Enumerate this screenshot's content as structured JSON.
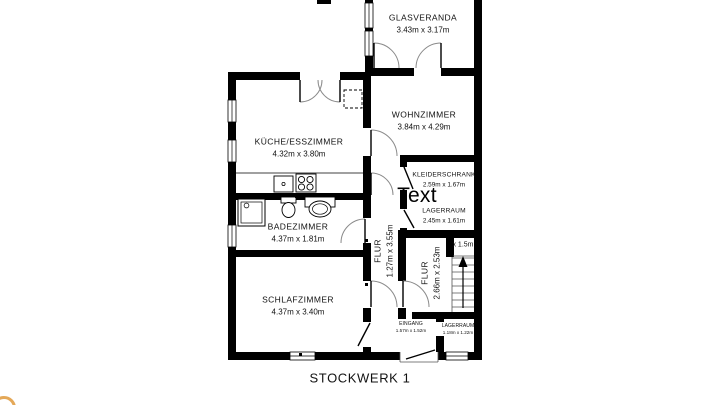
{
  "title": "STOCKWERK 1",
  "annotation": {
    "label": "Text"
  },
  "stairs": {
    "note": "x 1.5m",
    "icon": "up-arrow"
  },
  "rooms": {
    "glasveranda": {
      "name": "GLASVERANDA",
      "dims": "3.43m x 3.17m"
    },
    "wohnzimmer": {
      "name": "WOHNZIMMER",
      "dims": "3.84m x 4.29m"
    },
    "kueche": {
      "name": "KÜCHE/ESSZIMMER",
      "dims": "4.32m x 3.80m"
    },
    "kleiderschrank": {
      "name": "KLEIDERSCHRANK",
      "dims": "2.59m x 1.67m"
    },
    "lagerraum": {
      "name": "LAGERRAUM",
      "dims": "2.45m x 1.61m"
    },
    "flur1": {
      "name": "FLUR",
      "dims": "1.27m x 3.55m"
    },
    "badezimmer": {
      "name": "BADEZIMMER",
      "dims": "4.37m x 1.81m"
    },
    "schlafzimmer": {
      "name": "SCHLAFZIMMER",
      "dims": "4.37m x 3.40m"
    },
    "flur2": {
      "name": "FLUR",
      "dims": "2.66m x 2.53m"
    },
    "eingang": {
      "name": "EINGANG",
      "dims": "1.57m x 1.52m"
    },
    "lagerraum2": {
      "name": "LAGERRAUM",
      "dims": "1.18m x 1.22m"
    }
  },
  "colors": {
    "wall": "#000000",
    "thin_line": "#333333",
    "door_arc": "#8a8a8a",
    "label_text": "#111111",
    "background": "#ffffff",
    "logo": "#e09a3c"
  }
}
